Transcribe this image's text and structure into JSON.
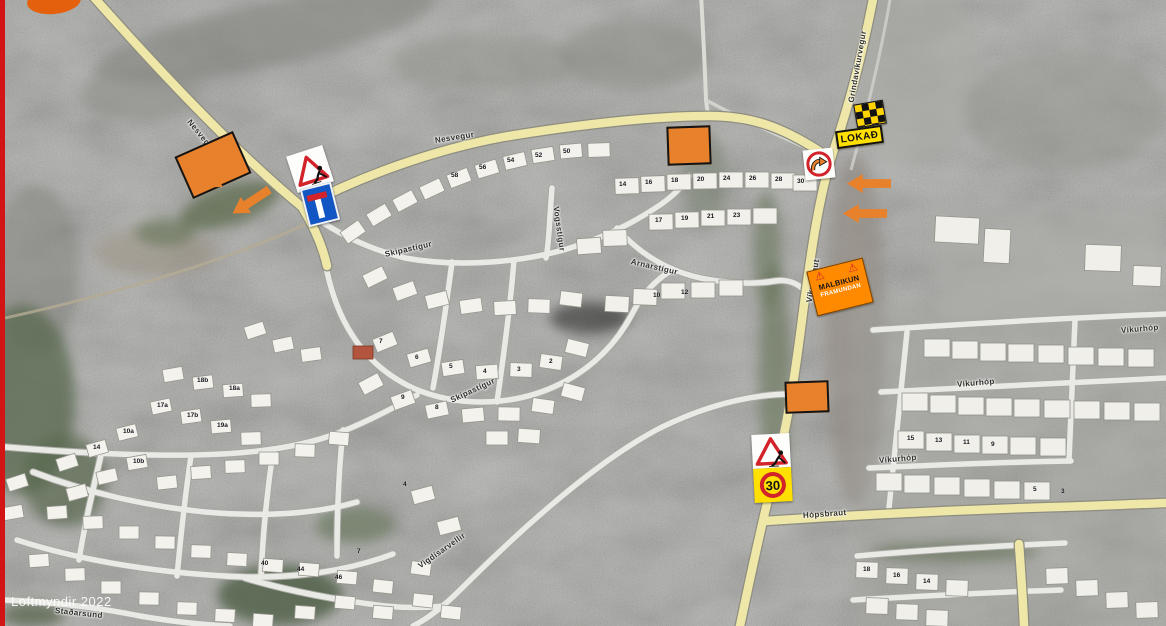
{
  "frame": {
    "border_color": "#d31414",
    "annotation_orange": "#e8812c"
  },
  "attribution": {
    "text": "Loftmyndir 2022"
  },
  "signs": {
    "closed_sign": {
      "label": "LOKAÐ"
    },
    "paving_sign": {
      "line1": "MALBIKUN",
      "line2": "FRAMUNDAN",
      "warning_icon": "⚠"
    },
    "temp_speed_sign": {
      "value": "30"
    }
  },
  "street_labels": [
    {
      "text": "Nesvegur",
      "style": {
        "left": "184px",
        "top": "116px",
        "transform": "rotate(51deg)"
      }
    },
    {
      "text": "Nesvegur",
      "style": {
        "left": "430px",
        "top": "136px",
        "transform": "rotate(-9deg)"
      }
    },
    {
      "text": "Grindavíkurvegur",
      "style": {
        "left": "846px",
        "top": "98px",
        "transform": "rotate(-80deg)"
      }
    },
    {
      "text": "Víkurbraut",
      "style": {
        "left": "804px",
        "top": "298px",
        "transform": "rotate(-80deg)"
      }
    },
    {
      "text": "Skipastígur",
      "style": {
        "left": "380px",
        "top": "250px",
        "transform": "rotate(-13deg)"
      }
    },
    {
      "text": "Skipastígur",
      "style": {
        "left": "446px",
        "top": "396px",
        "transform": "rotate(-25deg)"
      }
    },
    {
      "text": "Vogsstígur",
      "style": {
        "left": "551px",
        "top": "202px",
        "transform": "rotate(82deg)"
      }
    },
    {
      "text": "Arnarstígur",
      "style": {
        "left": "626px",
        "top": "257px",
        "transform": "rotate(13deg)"
      }
    },
    {
      "text": "Víkurhóp",
      "style": {
        "left": "952px",
        "top": "380px",
        "transform": "rotate(-5deg)"
      }
    },
    {
      "text": "Víkurhóp",
      "style": {
        "left": "874px",
        "top": "456px",
        "transform": "rotate(-5deg)"
      }
    },
    {
      "text": "Víkurhóp",
      "style": {
        "left": "1116px",
        "top": "326px",
        "transform": "rotate(-5deg)"
      }
    },
    {
      "text": "Hópsbraut",
      "style": {
        "left": "798px",
        "top": "511px",
        "transform": "rotate(-4deg)"
      }
    },
    {
      "text": "Vigdísarvellir",
      "style": {
        "left": "414px",
        "top": "562px",
        "transform": "rotate(-35deg)"
      }
    },
    {
      "text": "Staðarsund",
      "style": {
        "left": "50px",
        "top": "606px",
        "transform": "rotate(6deg)"
      }
    }
  ],
  "house_numbers": [
    {
      "text": "58",
      "style": {
        "left": "446px",
        "top": "172px"
      }
    },
    {
      "text": "56",
      "style": {
        "left": "474px",
        "top": "164px"
      }
    },
    {
      "text": "54",
      "style": {
        "left": "502px",
        "top": "157px"
      }
    },
    {
      "text": "52",
      "style": {
        "left": "530px",
        "top": "152px"
      }
    },
    {
      "text": "50",
      "style": {
        "left": "558px",
        "top": "148px"
      }
    },
    {
      "text": "14",
      "style": {
        "left": "614px",
        "top": "181px"
      }
    },
    {
      "text": "16",
      "style": {
        "left": "640px",
        "top": "179px"
      }
    },
    {
      "text": "18",
      "style": {
        "left": "666px",
        "top": "177px"
      }
    },
    {
      "text": "20",
      "style": {
        "left": "692px",
        "top": "176px"
      }
    },
    {
      "text": "24",
      "style": {
        "left": "718px",
        "top": "175px"
      }
    },
    {
      "text": "26",
      "style": {
        "left": "744px",
        "top": "175px"
      }
    },
    {
      "text": "28",
      "style": {
        "left": "770px",
        "top": "176px"
      }
    },
    {
      "text": "30",
      "style": {
        "left": "792px",
        "top": "178px"
      }
    },
    {
      "text": "17",
      "style": {
        "left": "650px",
        "top": "217px"
      }
    },
    {
      "text": "19",
      "style": {
        "left": "676px",
        "top": "215px"
      }
    },
    {
      "text": "21",
      "style": {
        "left": "702px",
        "top": "213px"
      }
    },
    {
      "text": "23",
      "style": {
        "left": "728px",
        "top": "212px"
      }
    },
    {
      "text": "10",
      "style": {
        "left": "648px",
        "top": "292px"
      }
    },
    {
      "text": "12",
      "style": {
        "left": "676px",
        "top": "289px"
      }
    },
    {
      "text": "7",
      "style": {
        "left": "374px",
        "top": "338px"
      }
    },
    {
      "text": "6",
      "style": {
        "left": "410px",
        "top": "354px"
      }
    },
    {
      "text": "5",
      "style": {
        "left": "444px",
        "top": "363px"
      }
    },
    {
      "text": "4",
      "style": {
        "left": "478px",
        "top": "368px"
      }
    },
    {
      "text": "3",
      "style": {
        "left": "512px",
        "top": "366px"
      }
    },
    {
      "text": "2",
      "style": {
        "left": "544px",
        "top": "358px"
      }
    },
    {
      "text": "9",
      "style": {
        "left": "396px",
        "top": "394px"
      }
    },
    {
      "text": "8",
      "style": {
        "left": "430px",
        "top": "404px"
      }
    },
    {
      "text": "18b",
      "style": {
        "left": "192px",
        "top": "377px"
      }
    },
    {
      "text": "18a",
      "style": {
        "left": "224px",
        "top": "385px"
      }
    },
    {
      "text": "17a",
      "style": {
        "left": "152px",
        "top": "402px"
      }
    },
    {
      "text": "17b",
      "style": {
        "left": "182px",
        "top": "412px"
      }
    },
    {
      "text": "19a",
      "style": {
        "left": "212px",
        "top": "422px"
      }
    },
    {
      "text": "10a",
      "style": {
        "left": "118px",
        "top": "428px"
      }
    },
    {
      "text": "10b",
      "style": {
        "left": "128px",
        "top": "458px"
      }
    },
    {
      "text": "14",
      "style": {
        "left": "88px",
        "top": "444px"
      }
    },
    {
      "text": "40",
      "style": {
        "left": "256px",
        "top": "560px"
      }
    },
    {
      "text": "44",
      "style": {
        "left": "292px",
        "top": "566px"
      }
    },
    {
      "text": "46",
      "style": {
        "left": "330px",
        "top": "574px"
      }
    },
    {
      "text": "4",
      "style": {
        "left": "398px",
        "top": "481px"
      }
    },
    {
      "text": "7",
      "style": {
        "left": "352px",
        "top": "548px"
      }
    },
    {
      "text": "15",
      "style": {
        "left": "902px",
        "top": "435px"
      }
    },
    {
      "text": "13",
      "style": {
        "left": "930px",
        "top": "437px"
      }
    },
    {
      "text": "11",
      "style": {
        "left": "958px",
        "top": "439px"
      }
    },
    {
      "text": "9",
      "style": {
        "left": "986px",
        "top": "441px"
      }
    },
    {
      "text": "5",
      "style": {
        "left": "1028px",
        "top": "486px"
      }
    },
    {
      "text": "3",
      "style": {
        "left": "1056px",
        "top": "488px"
      }
    },
    {
      "text": "18",
      "style": {
        "left": "858px",
        "top": "566px"
      }
    },
    {
      "text": "16",
      "style": {
        "left": "888px",
        "top": "572px"
      }
    },
    {
      "text": "14",
      "style": {
        "left": "918px",
        "top": "578px"
      }
    }
  ],
  "markers": [
    {
      "style": {
        "left": "176px",
        "top": "142px",
        "width": "60px",
        "height": "42px",
        "transform": "rotate(-24deg)"
      }
    },
    {
      "style": {
        "left": "662px",
        "top": "126px",
        "width": "40px",
        "height": "35px",
        "transform": "rotate(-2deg)"
      }
    },
    {
      "style": {
        "left": "780px",
        "top": "381px",
        "width": "40px",
        "height": "28px",
        "transform": "rotate(-2deg)"
      }
    }
  ],
  "arrows": [
    {
      "style": {
        "left": "196px",
        "top": "166px",
        "transform": "rotate(-33deg)"
      }
    },
    {
      "style": {
        "left": "224px",
        "top": "192px",
        "transform": "rotate(-33deg)"
      }
    },
    {
      "style": {
        "left": "842px",
        "top": "174px"
      }
    },
    {
      "style": {
        "left": "838px",
        "top": "204px"
      }
    }
  ]
}
